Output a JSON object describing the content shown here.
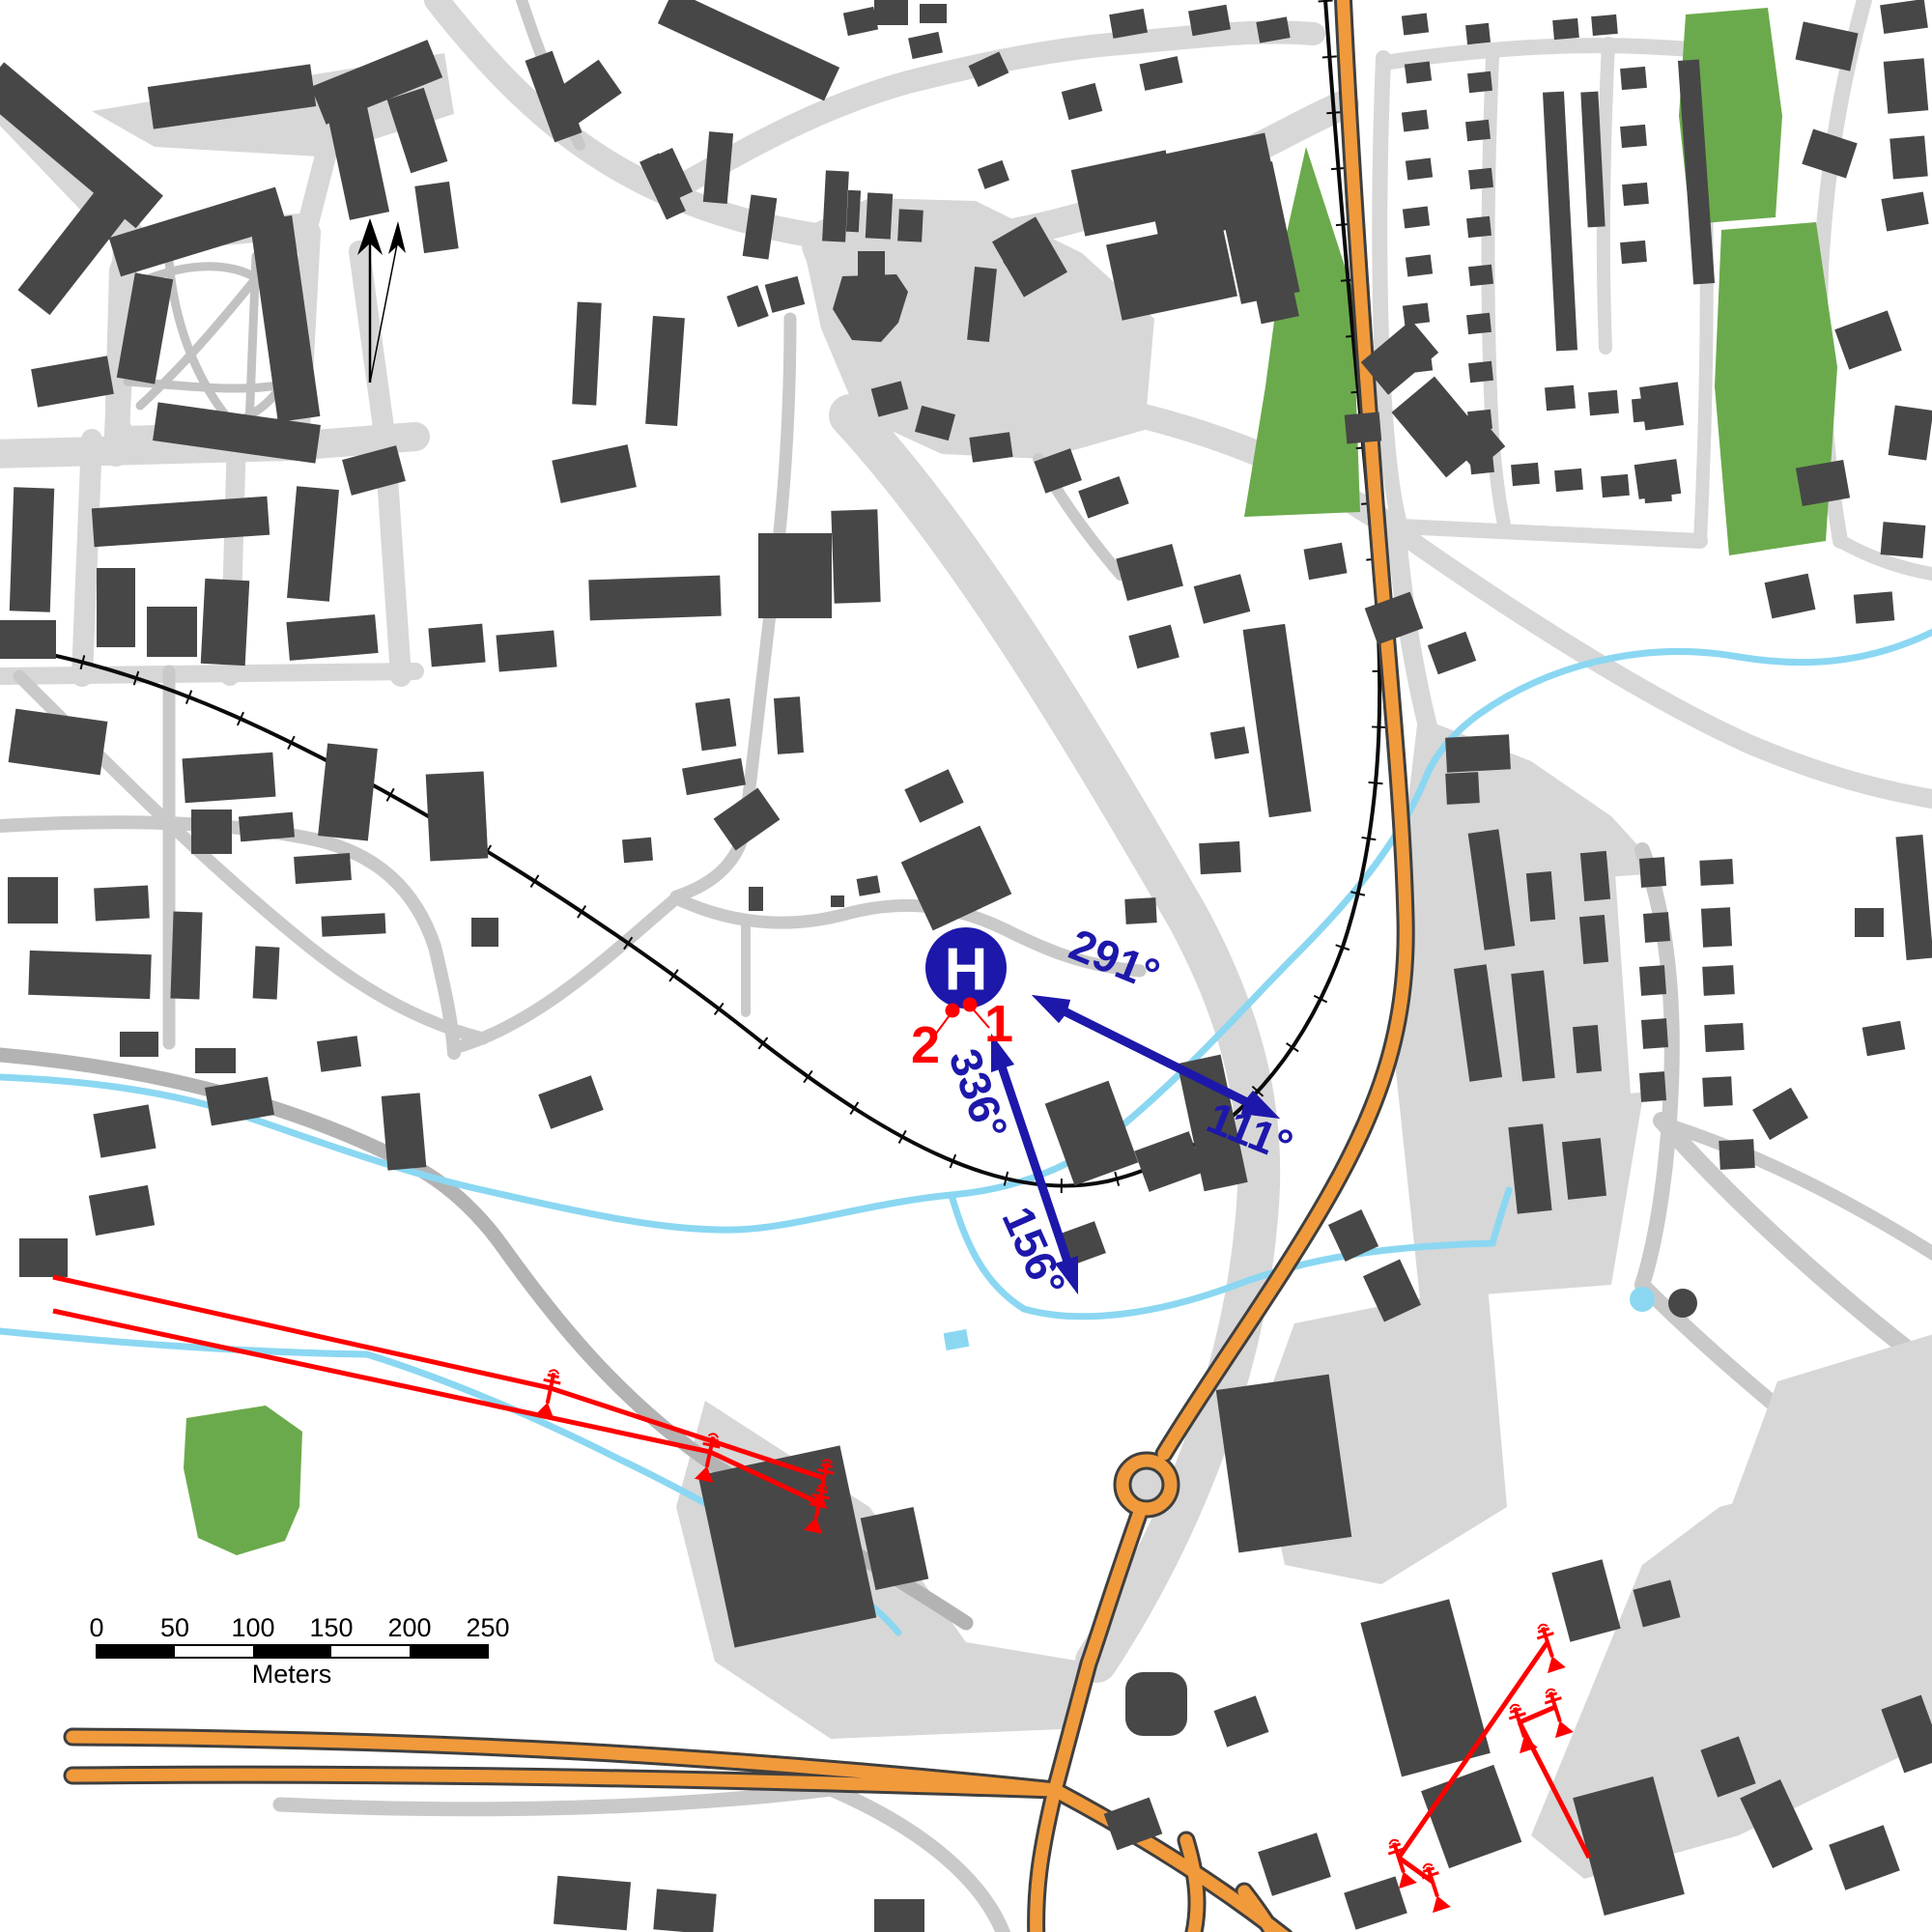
{
  "annotations": {
    "helipad": {
      "symbol": "H"
    },
    "bearings": [
      {
        "label": "291°"
      },
      {
        "label": "111°"
      },
      {
        "label": "336°"
      },
      {
        "label": "156°"
      }
    ],
    "points": [
      {
        "label": "1"
      },
      {
        "label": "2"
      }
    ],
    "scale_bar": {
      "ticks": [
        "0",
        "50",
        "100",
        "150",
        "200",
        "250"
      ],
      "unit": "Meters"
    }
  },
  "legend_colors": {
    "annotation_blue": "#1d18aa",
    "annotation_red": "#ff0000",
    "building_gray": "#474747",
    "road_light": "#d7d7d7",
    "road_medium": "#c9c9c9",
    "road_dark": "#b3b3b3",
    "highway_orange": "#f09a3c",
    "highway_casing": "#3f3f3f",
    "water_blue": "#8bd7f2",
    "green_area": "#6baa4c",
    "railway_black": "#000000"
  }
}
